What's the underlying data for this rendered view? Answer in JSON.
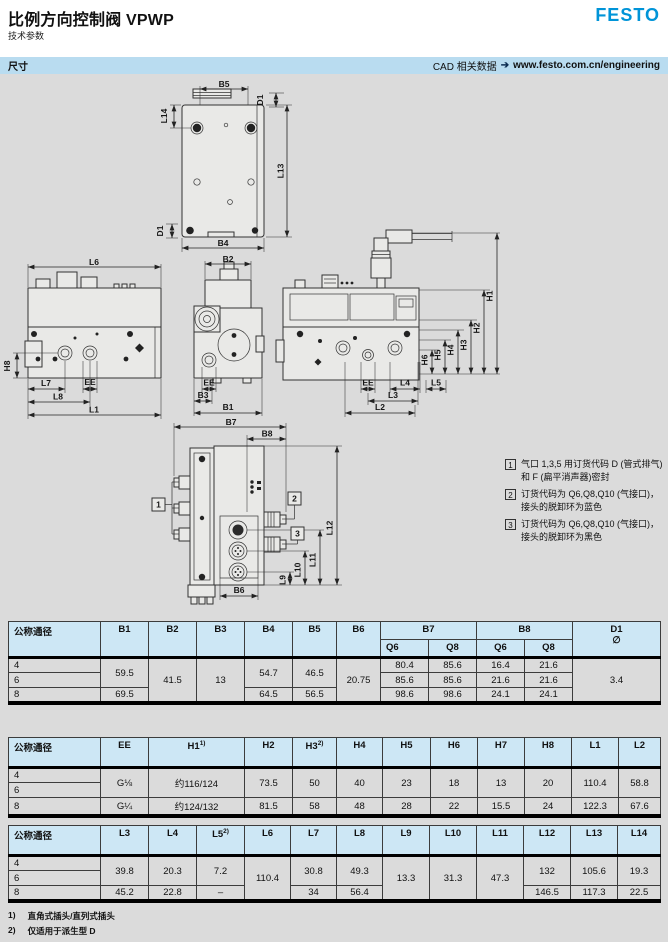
{
  "header": {
    "title": "比例方向控制阀 VPWP",
    "subtitle": "技术参数",
    "logo": "FESTO"
  },
  "section_bar": {
    "left": "尺寸",
    "cad_label": "CAD 相关数据",
    "arrow": "➔",
    "url": "www.festo.com.cn/engineering"
  },
  "drawing": {
    "labels": {
      "B5": "B5",
      "L14": "L14",
      "D1": "D1",
      "L13": "L13",
      "B4": "B4",
      "L6": "L6",
      "H8": "H8",
      "L7": "L7",
      "L8": "L8",
      "EE": "EE",
      "L1": "L1",
      "B2": "B2",
      "B3": "B3",
      "B1": "B1",
      "B7": "B7",
      "B8": "B8",
      "H1": "H1",
      "H2": "H2",
      "H3": "H3",
      "H4": "H4",
      "H5": "H5",
      "H6": "H6",
      "L4": "L4",
      "L5": "L5",
      "L3": "L3",
      "L2": "L2",
      "L12": "L12",
      "L11": "L11",
      "L10": "L10",
      "L9": "L9",
      "B6": "B6"
    }
  },
  "notes": [
    {
      "num": "1",
      "text": "气口 1,3,5 用订货代码 D (管式排气)和 F (扁平消声器)密封"
    },
    {
      "num": "2",
      "text": "订货代码为 Q6,Q8,Q10 (气接口)，接头的脱卸环为蓝色"
    },
    {
      "num": "3",
      "text": "订货代码为 Q6,Q8,Q10 (气接口)，接头的脱卸环为黑色"
    }
  ],
  "tables": [
    {
      "title": "B/D dimensions",
      "col_widths": [
        92,
        48,
        48,
        48,
        48,
        44,
        44,
        48,
        48,
        48,
        48,
        88
      ],
      "header": [
        [
          {
            "t": "公称通径",
            "rs": 2
          },
          {
            "t": "B1",
            "rs": 2
          },
          {
            "t": "B2",
            "rs": 2
          },
          {
            "t": "B3",
            "rs": 2
          },
          {
            "t": "B4",
            "rs": 2
          },
          {
            "t": "B5",
            "rs": 2
          },
          {
            "t": "B6",
            "rs": 2
          },
          {
            "t": "B7",
            "cs": 2
          },
          {
            "t": "B8",
            "cs": 2
          },
          {
            "t": "D1",
            "rs": 2,
            "lines": [
              "D1",
              "∅"
            ]
          }
        ],
        [
          {
            "t": "Q6"
          },
          {
            "t": "Q8"
          },
          {
            "t": "Q6"
          },
          {
            "t": "Q8"
          }
        ]
      ],
      "rows": [
        [
          {
            "t": "4"
          },
          {
            "t": "59.5",
            "rs": 2
          },
          {
            "t": "41.5",
            "rs": 3
          },
          {
            "t": "13",
            "rs": 3
          },
          {
            "t": "54.7",
            "rs": 2
          },
          {
            "t": "46.5",
            "rs": 2
          },
          {
            "t": "20.75",
            "rs": 3
          },
          {
            "t": "80.4"
          },
          {
            "t": "85.6"
          },
          {
            "t": "16.4"
          },
          {
            "t": "21.6"
          },
          {
            "t": "3.4",
            "rs": 3
          }
        ],
        [
          {
            "t": "6"
          },
          {
            "t": "85.6"
          },
          {
            "t": "85.6"
          },
          {
            "t": "21.6"
          },
          {
            "t": "21.6"
          }
        ],
        [
          {
            "t": "8"
          },
          {
            "t": "69.5"
          },
          {
            "t": "64.5"
          },
          {
            "t": "56.5"
          },
          {
            "t": "98.6"
          },
          {
            "t": "98.6"
          },
          {
            "t": "24.1"
          },
          {
            "t": "24.1"
          }
        ]
      ]
    },
    {
      "title": "EE/H/L dimensions",
      "col_widths": [
        92,
        48,
        96,
        48,
        44,
        46,
        48,
        47,
        47,
        47,
        47,
        42
      ],
      "header": [
        [
          {
            "t": "公称通径"
          },
          {
            "t": "EE"
          },
          {
            "t": "H1",
            "sup": "1)"
          },
          {
            "t": "H2"
          },
          {
            "t": "H3",
            "sup": "2)"
          },
          {
            "t": "H4"
          },
          {
            "t": "H5"
          },
          {
            "t": "H6"
          },
          {
            "t": "H7"
          },
          {
            "t": "H8"
          },
          {
            "t": "L1"
          },
          {
            "t": "L2"
          }
        ]
      ],
      "rows": [
        [
          {
            "t": "4"
          },
          {
            "t": "G⅛",
            "rs": 2
          },
          {
            "t": "约116/124",
            "rs": 2
          },
          {
            "t": "73.5",
            "rs": 2
          },
          {
            "t": "50",
            "rs": 2
          },
          {
            "t": "40",
            "rs": 2
          },
          {
            "t": "23",
            "rs": 2
          },
          {
            "t": "18",
            "rs": 2
          },
          {
            "t": "13",
            "rs": 2
          },
          {
            "t": "20",
            "rs": 2
          },
          {
            "t": "110.4",
            "rs": 2
          },
          {
            "t": "58.8",
            "rs": 2
          }
        ],
        [
          {
            "t": "6"
          }
        ],
        [
          {
            "t": "8"
          },
          {
            "t": "G¼"
          },
          {
            "t": "约124/132"
          },
          {
            "t": "81.5"
          },
          {
            "t": "58"
          },
          {
            "t": "48"
          },
          {
            "t": "28"
          },
          {
            "t": "22"
          },
          {
            "t": "15.5"
          },
          {
            "t": "24"
          },
          {
            "t": "122.3"
          },
          {
            "t": "67.6"
          }
        ]
      ]
    },
    {
      "title": "L dimensions",
      "col_widths": [
        92,
        48,
        48,
        48,
        46,
        46,
        46,
        47,
        47,
        47,
        47,
        47,
        43
      ],
      "header": [
        [
          {
            "t": "公称通径"
          },
          {
            "t": "L3"
          },
          {
            "t": "L4"
          },
          {
            "t": "L5",
            "sup": "2)"
          },
          {
            "t": "L6"
          },
          {
            "t": "L7"
          },
          {
            "t": "L8"
          },
          {
            "t": "L9"
          },
          {
            "t": "L10"
          },
          {
            "t": "L11"
          },
          {
            "t": "L12"
          },
          {
            "t": "L13"
          },
          {
            "t": "L14"
          }
        ]
      ],
      "rows": [
        [
          {
            "t": "4"
          },
          {
            "t": "39.8",
            "rs": 2
          },
          {
            "t": "20.3",
            "rs": 2
          },
          {
            "t": "7.2",
            "rs": 2
          },
          {
            "t": "110.4",
            "rs": 3
          },
          {
            "t": "30.8",
            "rs": 2
          },
          {
            "t": "49.3",
            "rs": 2
          },
          {
            "t": "13.3",
            "rs": 3
          },
          {
            "t": "31.3",
            "rs": 3
          },
          {
            "t": "47.3",
            "rs": 3
          },
          {
            "t": "132",
            "rs": 2
          },
          {
            "t": "105.6",
            "rs": 2
          },
          {
            "t": "19.3",
            "rs": 2
          }
        ],
        [
          {
            "t": "6"
          }
        ],
        [
          {
            "t": "8"
          },
          {
            "t": "45.2"
          },
          {
            "t": "22.8"
          },
          {
            "t": "–"
          },
          {
            "t": "34"
          },
          {
            "t": "56.4"
          },
          {
            "t": "146.5"
          },
          {
            "t": "117.3"
          },
          {
            "t": "22.5"
          }
        ]
      ]
    }
  ],
  "footnotes": [
    {
      "num": "1)",
      "text": "直角式插头/直列式插头"
    },
    {
      "num": "2)",
      "text": "仅适用于派生型 D"
    }
  ],
  "colors": {
    "festo_blue": "#0094d8",
    "bar_bg": "#b9dcf0",
    "table_header_bg": "#cde7f5"
  }
}
